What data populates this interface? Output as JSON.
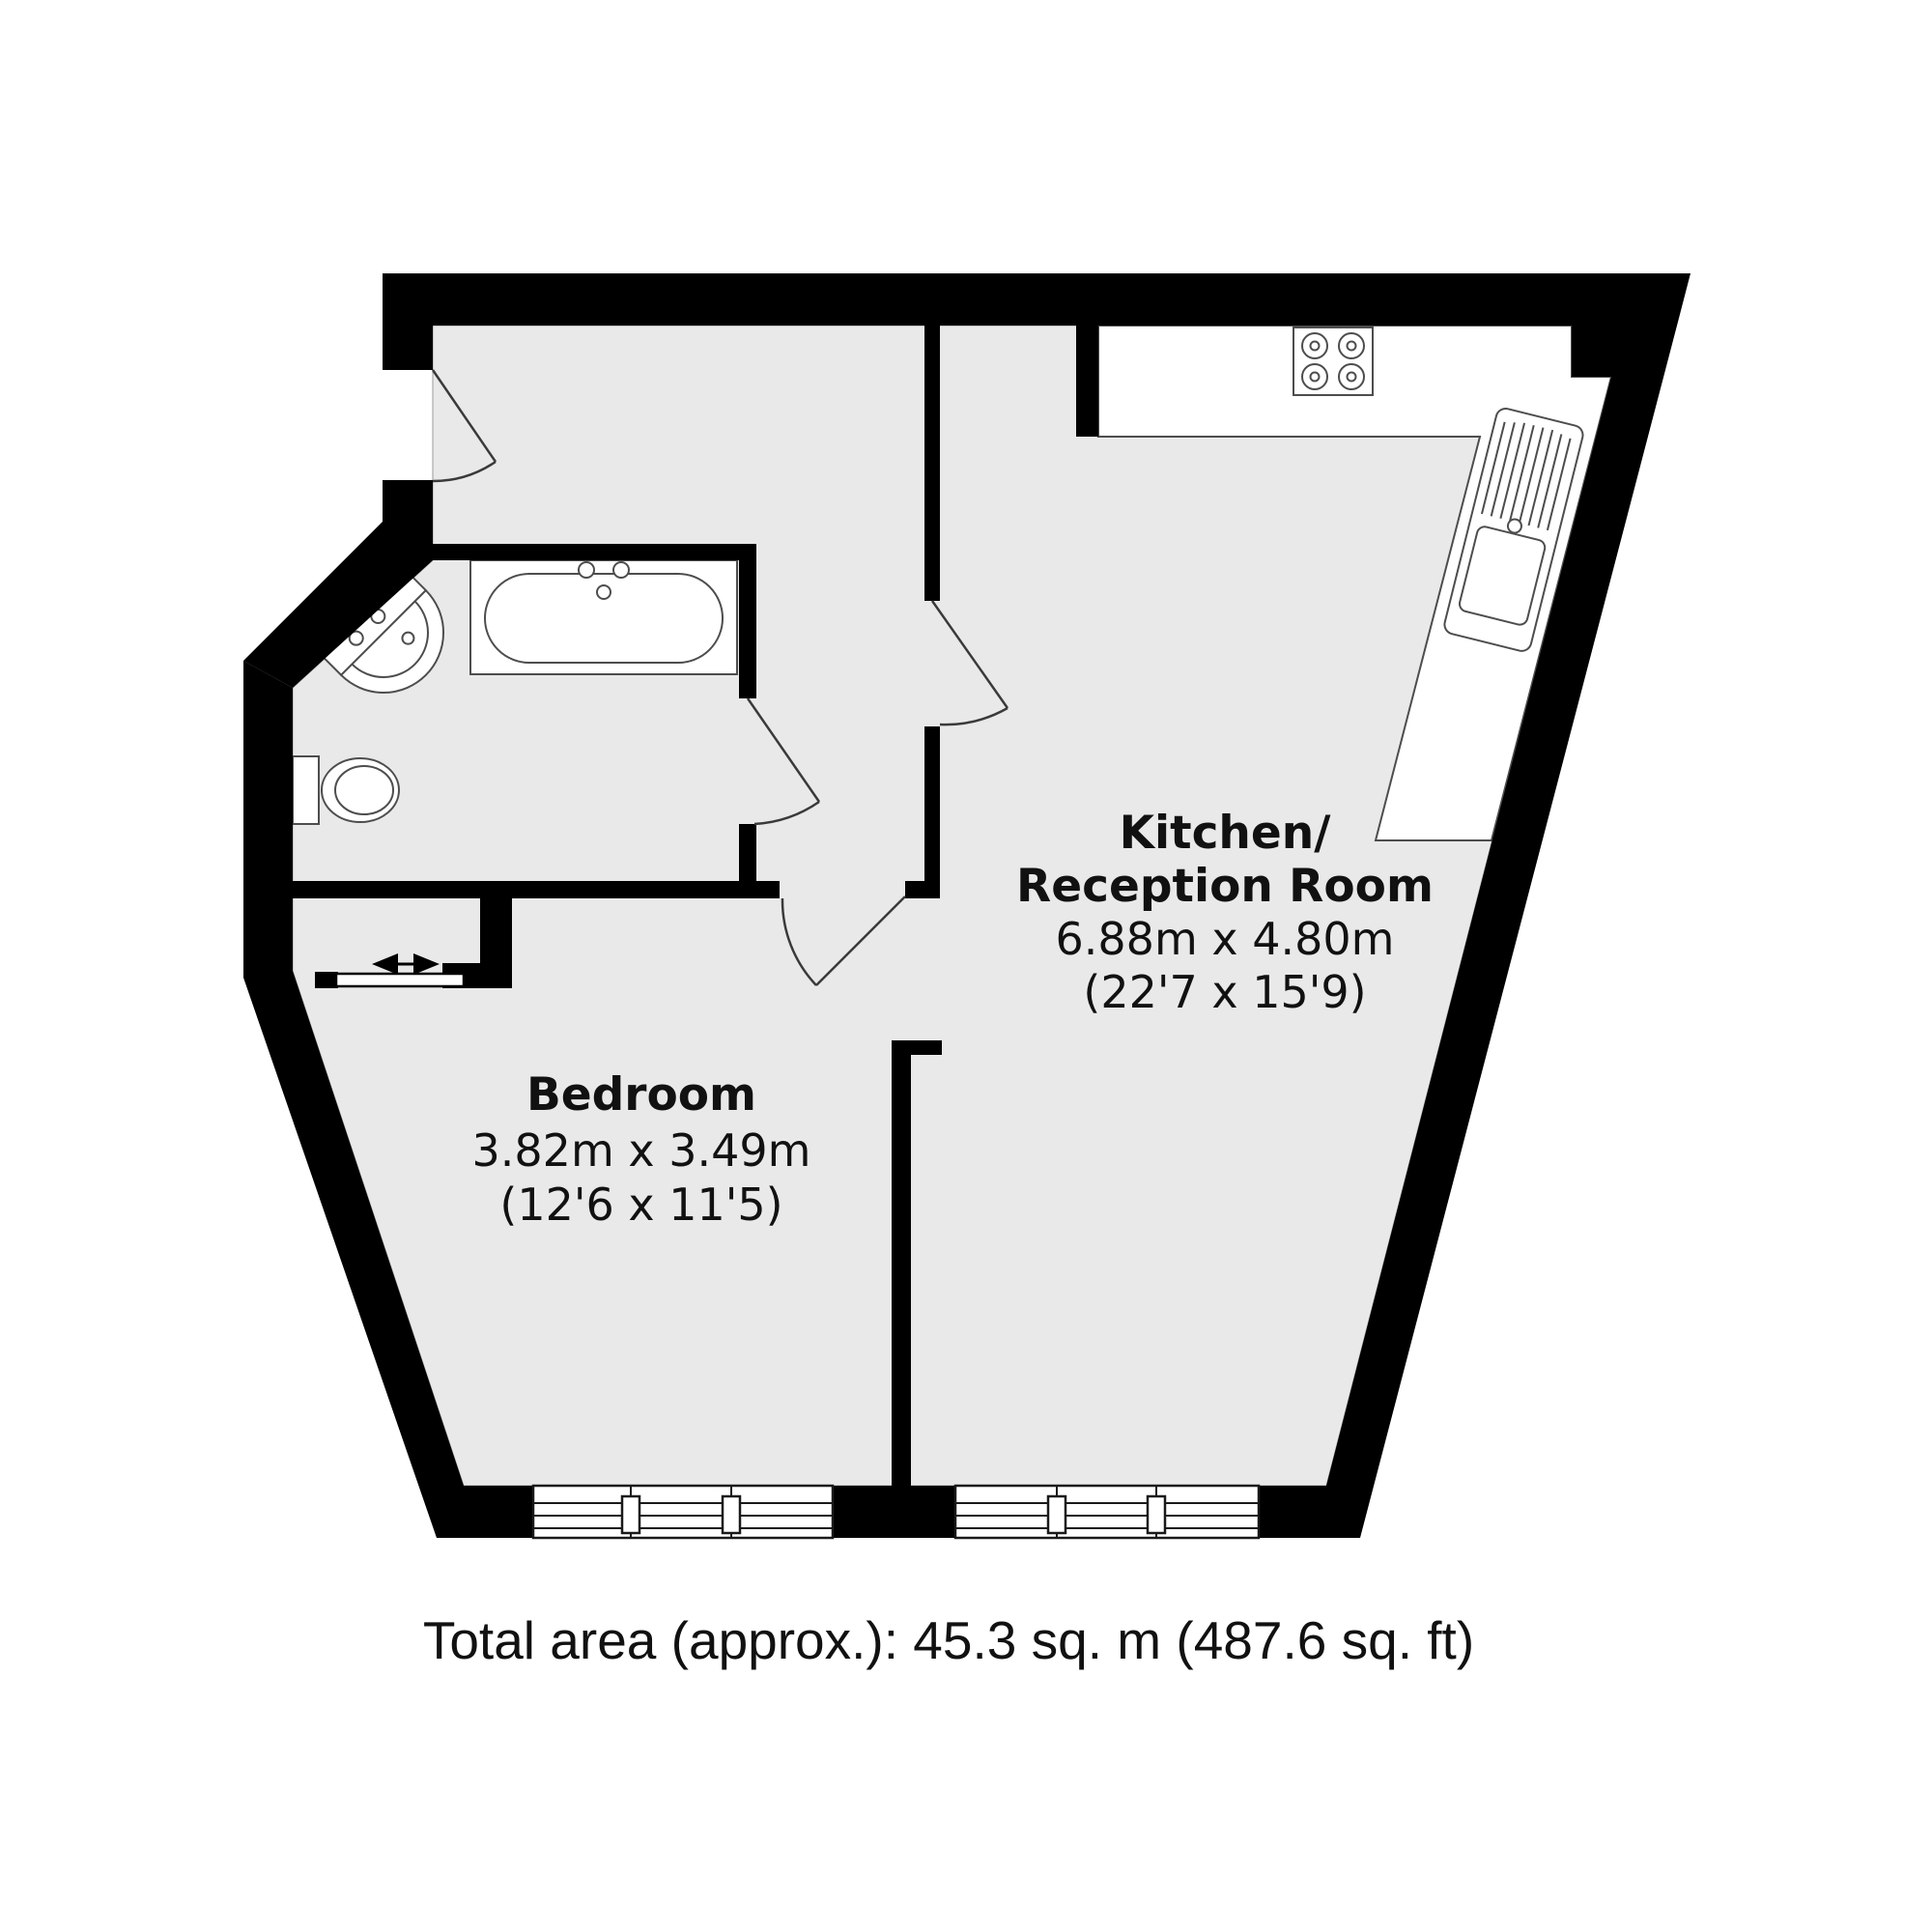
{
  "plan": {
    "rooms": [
      {
        "id": "kitchen-reception",
        "name_line1": "Kitchen/",
        "name_line2": "Reception Room",
        "dimensions_metric": "6.88m x 4.80m",
        "dimensions_imperial": "(22'7 x 15'9)"
      },
      {
        "id": "bedroom",
        "name": "Bedroom",
        "dimensions_metric": "3.82m x 3.49m",
        "dimensions_imperial": "(12'6 x 11'5)"
      }
    ],
    "total_area_label": "Total area (approx.): 45.3 sq. m (487.6 sq. ft)",
    "colors": {
      "wall": "#000000",
      "floor": "#e9e9e9",
      "fixture_outline": "#4d4d4d",
      "door_line": "#3a3a3a",
      "text": "#111111",
      "background": "#ffffff"
    },
    "fixtures": [
      "bathtub",
      "wash-basin",
      "toilet",
      "hob",
      "sink-drainer-unit",
      "sliding-door",
      "casement-windows"
    ]
  }
}
